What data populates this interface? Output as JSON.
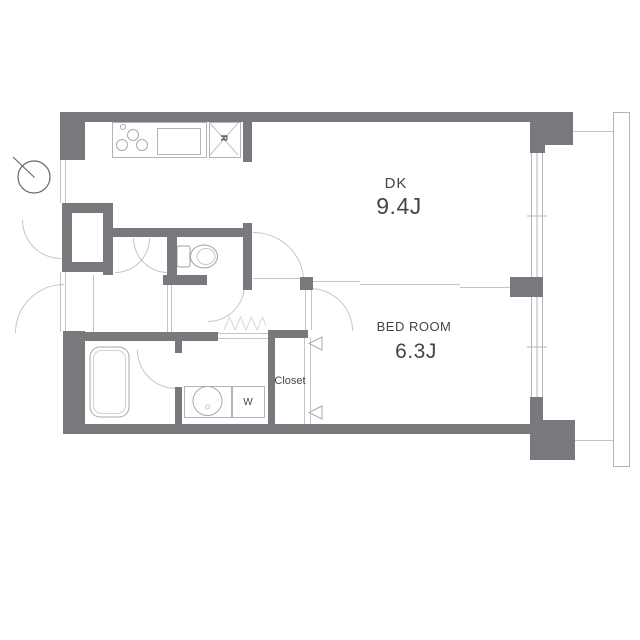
{
  "plan": {
    "type": "apartment-floor-plan",
    "rooms": {
      "dk": {
        "label": "DK",
        "area": "9.4J"
      },
      "bedroom": {
        "label": "BED ROOM",
        "area": "6.3J"
      },
      "closet": {
        "label": "Closet"
      },
      "laundry": {
        "label": "W"
      },
      "refrigerator": {
        "label": "R"
      }
    },
    "colors": {
      "wall": "#77797c",
      "line": "#c3c6c8",
      "text": "#42464a",
      "bg": "#ffffff"
    }
  }
}
